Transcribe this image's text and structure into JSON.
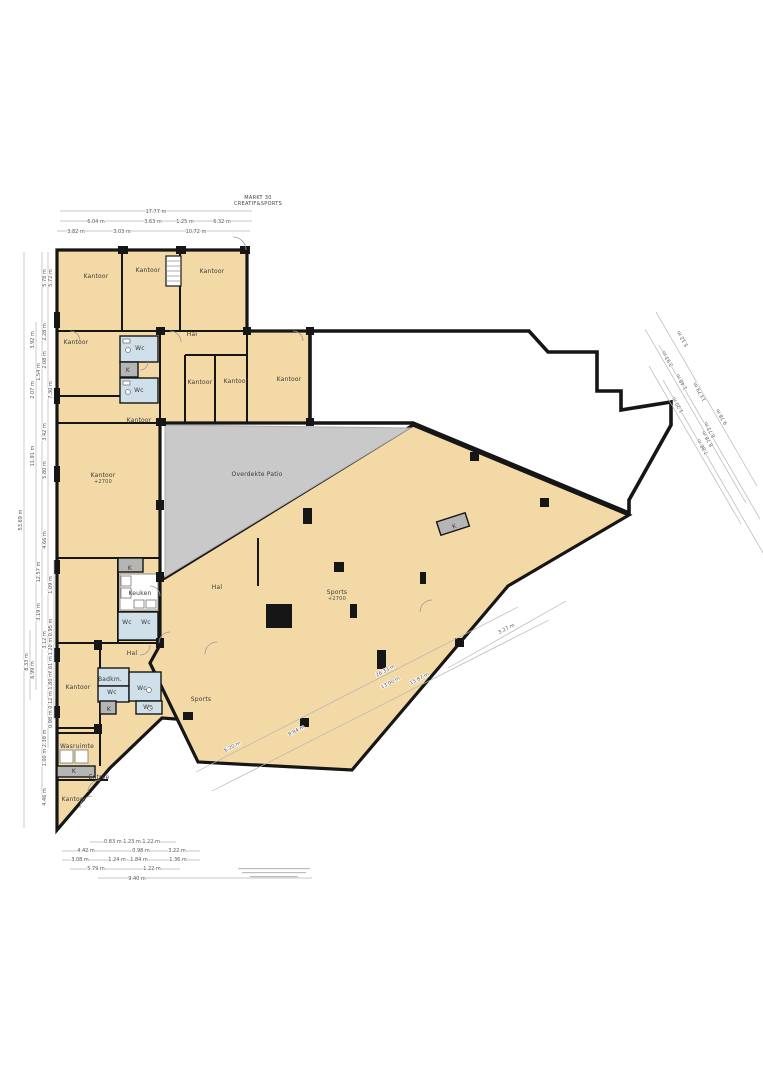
{
  "title": {
    "line1": "MARKT 30",
    "line2": "CREATIF&SPORTS"
  },
  "colors": {
    "room_fill": "#f3d9a6",
    "wet_room_fill": "#cfe0ea",
    "patio_fill": "#c9c9c9",
    "k_box_fill": "#b5b5b5",
    "wall": "#161616",
    "dim_line": "#b5b5b5"
  },
  "room_labels": [
    {
      "x": 96,
      "y": 278,
      "text": "Kantoor"
    },
    {
      "x": 148,
      "y": 272,
      "text": "Kantoor"
    },
    {
      "x": 212,
      "y": 273,
      "text": "Kantoor"
    },
    {
      "x": 192,
      "y": 336,
      "text": "Hal"
    },
    {
      "x": 76,
      "y": 344,
      "text": "Kantoor"
    },
    {
      "x": 140,
      "y": 350,
      "text": "Wc"
    },
    {
      "x": 128,
      "y": 372,
      "text": "K"
    },
    {
      "x": 139,
      "y": 392,
      "text": "Wc"
    },
    {
      "x": 200,
      "y": 384,
      "text": "Kantoor"
    },
    {
      "x": 236,
      "y": 383,
      "text": "Kantoor"
    },
    {
      "x": 289,
      "y": 381,
      "text": "Kantoor"
    },
    {
      "x": 139,
      "y": 422,
      "text": "Kantoor"
    },
    {
      "x": 257,
      "y": 476,
      "text": "Overdekte Patio"
    },
    {
      "x": 103,
      "y": 477,
      "text": "Kantoor",
      "sub": "+2700"
    },
    {
      "x": 217,
      "y": 589,
      "text": "Hal"
    },
    {
      "x": 337,
      "y": 594,
      "text": "Sports",
      "sub": "+2700"
    },
    {
      "x": 140,
      "y": 595,
      "text": "Keuken"
    },
    {
      "x": 130,
      "y": 570,
      "text": "K"
    },
    {
      "x": 127,
      "y": 624,
      "text": "Wc"
    },
    {
      "x": 146,
      "y": 624,
      "text": "Wc"
    },
    {
      "x": 132,
      "y": 655,
      "text": "Hal"
    },
    {
      "x": 110,
      "y": 681,
      "text": "Badkm."
    },
    {
      "x": 112,
      "y": 694,
      "text": "Wc"
    },
    {
      "x": 142,
      "y": 690,
      "text": "Wc"
    },
    {
      "x": 148,
      "y": 709,
      "text": "Wc"
    },
    {
      "x": 109,
      "y": 711,
      "text": "K"
    },
    {
      "x": 78,
      "y": 689,
      "text": "Kantoor"
    },
    {
      "x": 201,
      "y": 701,
      "text": "Sports"
    },
    {
      "x": 77,
      "y": 748,
      "text": "Wasruimte"
    },
    {
      "x": 74,
      "y": 773,
      "text": "K"
    },
    {
      "x": 99,
      "y": 779,
      "text": "Entree"
    },
    {
      "x": 74,
      "y": 801,
      "text": "Kantoor"
    },
    {
      "x": 455,
      "y": 528,
      "text": "K",
      "rot": -20
    }
  ],
  "dims_top": [
    {
      "x": 156,
      "y": 213,
      "text": "17.77 m"
    },
    {
      "x": 96,
      "y": 223,
      "text": "6.04 m"
    },
    {
      "x": 153,
      "y": 223,
      "text": "3.63 m"
    },
    {
      "x": 185,
      "y": 223,
      "text": "1.25 m"
    },
    {
      "x": 222,
      "y": 223,
      "text": "6.32 m"
    },
    {
      "x": 76,
      "y": 233,
      "text": "3.82 m"
    },
    {
      "x": 122,
      "y": 233,
      "text": "3.03 m"
    },
    {
      "x": 196,
      "y": 233,
      "text": "10.72 m"
    }
  ],
  "dims_left": [
    {
      "x": 46,
      "y": 278,
      "text": "5.78 m"
    },
    {
      "x": 52,
      "y": 278,
      "text": "5.72 m"
    },
    {
      "x": 34,
      "y": 340,
      "text": "3.92 m"
    },
    {
      "x": 46,
      "y": 332,
      "text": "2.28 m"
    },
    {
      "x": 46,
      "y": 360,
      "text": "2.08 m"
    },
    {
      "x": 40,
      "y": 372,
      "text": "1.54 m"
    },
    {
      "x": 34,
      "y": 390,
      "text": "2.07 m"
    },
    {
      "x": 52,
      "y": 390,
      "text": "7.30 m"
    },
    {
      "x": 46,
      "y": 432,
      "text": "3.42 m"
    },
    {
      "x": 34,
      "y": 456,
      "text": "11.91 m"
    },
    {
      "x": 46,
      "y": 470,
      "text": "5.80 m"
    },
    {
      "x": 22,
      "y": 520,
      "text": "53.69 m"
    },
    {
      "x": 46,
      "y": 540,
      "text": "4.66 m"
    },
    {
      "x": 40,
      "y": 572,
      "text": "12.57 m"
    },
    {
      "x": 52,
      "y": 585,
      "text": "1.09 m"
    },
    {
      "x": 40,
      "y": 612,
      "text": "3.19 m"
    },
    {
      "x": 46,
      "y": 640,
      "text": "3.12 m"
    },
    {
      "x": 52,
      "y": 637,
      "text": "1.20 m 0.95 m"
    },
    {
      "x": 52,
      "y": 665,
      "text": "2.61 m"
    },
    {
      "x": 52,
      "y": 700,
      "text": "0.98 m 0.12 m 1.80 m"
    },
    {
      "x": 28,
      "y": 662,
      "text": "8.33 m"
    },
    {
      "x": 34,
      "y": 670,
      "text": "6.99 m"
    },
    {
      "x": 46,
      "y": 748,
      "text": "1.00 m 2.38 m"
    },
    {
      "x": 46,
      "y": 797,
      "text": "4.46 m"
    }
  ],
  "dims_bottom": [
    {
      "x": 132,
      "y": 843,
      "text": "0.83 m 1.23 m 1.22 m"
    },
    {
      "x": 86,
      "y": 852,
      "text": "4.42 m"
    },
    {
      "x": 141,
      "y": 852,
      "text": "0.98 m"
    },
    {
      "x": 177,
      "y": 852,
      "text": "3.22 m"
    },
    {
      "x": 80,
      "y": 861,
      "text": "3.08 m"
    },
    {
      "x": 117,
      "y": 861,
      "text": "1.24 m"
    },
    {
      "x": 139,
      "y": 861,
      "text": "1.84 m"
    },
    {
      "x": 178,
      "y": 861,
      "text": "1.36 m"
    },
    {
      "x": 96,
      "y": 870,
      "text": "5.79 m"
    },
    {
      "x": 152,
      "y": 870,
      "text": "1.22 m"
    },
    {
      "x": 137,
      "y": 880,
      "text": "9.40 m"
    }
  ],
  "dims_diag_se": [
    {
      "x": 233,
      "y": 748,
      "text": "6.20 m",
      "rot": -27
    },
    {
      "x": 297,
      "y": 732,
      "text": "8.84 m",
      "rot": -27
    },
    {
      "x": 386,
      "y": 672,
      "text": "26.33 m",
      "rot": -27
    },
    {
      "x": 391,
      "y": 684,
      "text": "13.00 m",
      "rot": -27
    },
    {
      "x": 420,
      "y": 680,
      "text": "15.87 m",
      "rot": -27
    },
    {
      "x": 507,
      "y": 630,
      "text": "3.27 m",
      "rot": -27
    }
  ],
  "dims_diag_ne": [
    {
      "x": 684,
      "y": 338,
      "text": "5.12 m",
      "rot": -120
    },
    {
      "x": 669,
      "y": 358,
      "text": "3.93 m",
      "rot": -120
    },
    {
      "x": 683,
      "y": 381,
      "text": "1.48 m",
      "rot": -120
    },
    {
      "x": 701,
      "y": 391,
      "text": "13.79 m",
      "rot": -120
    },
    {
      "x": 679,
      "y": 404,
      "text": "1.20 m",
      "rot": -120
    },
    {
      "x": 723,
      "y": 416,
      "text": "9.78 m",
      "rot": -120
    },
    {
      "x": 711,
      "y": 429,
      "text": "8.73 m",
      "rot": -120
    },
    {
      "x": 709,
      "y": 438,
      "text": "8.78 m",
      "rot": -120
    },
    {
      "x": 704,
      "y": 446,
      "text": "7.86 m",
      "rot": -120
    }
  ]
}
